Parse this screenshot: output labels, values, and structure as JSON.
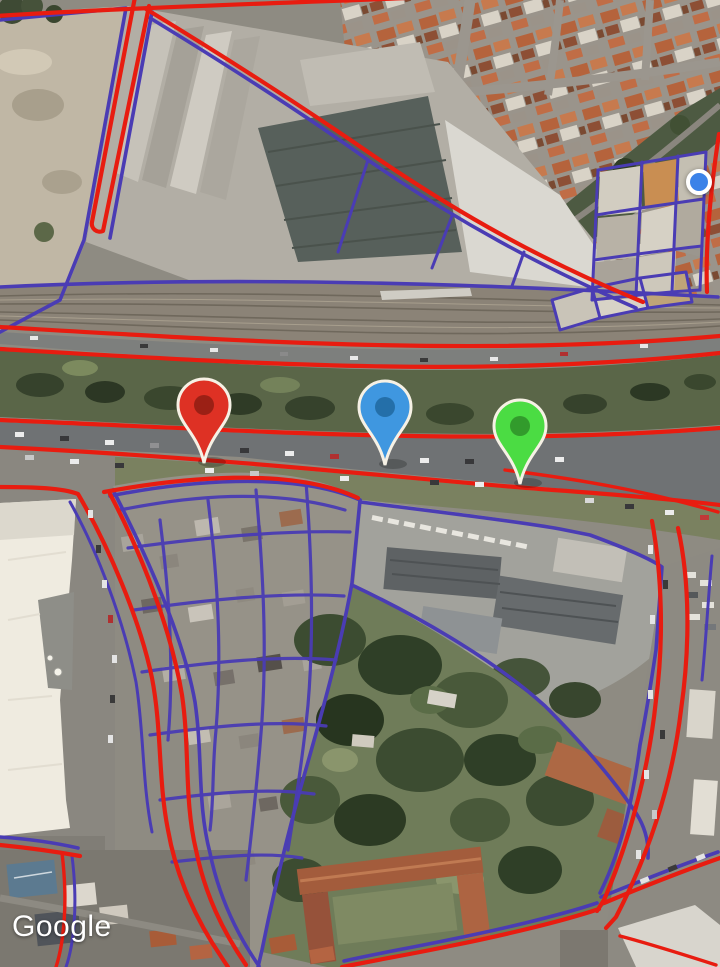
{
  "watermark": {
    "label": "Google"
  },
  "overlays": {
    "boundary_color": "#e81c10",
    "parcel_color": "#4a3cb4"
  },
  "markers": {
    "pins": [
      {
        "id": "red-pin",
        "color": "#de3124",
        "inner_color": "#8f1d13",
        "outline": "#f6f1e5",
        "x": 204,
        "y": 470
      },
      {
        "id": "blue-pin",
        "color": "#3f97e0",
        "inner_color": "#20679f",
        "outline": "#f6f1e5",
        "x": 385,
        "y": 472
      },
      {
        "id": "green-pin",
        "color": "#4bdc43",
        "inner_color": "#2e8f28",
        "outline": "#f6f1e5",
        "x": 520,
        "y": 491
      }
    ],
    "location_dot": {
      "color": "#3b82e8",
      "outline": "#ffffff",
      "x": 699,
      "y": 182
    }
  }
}
